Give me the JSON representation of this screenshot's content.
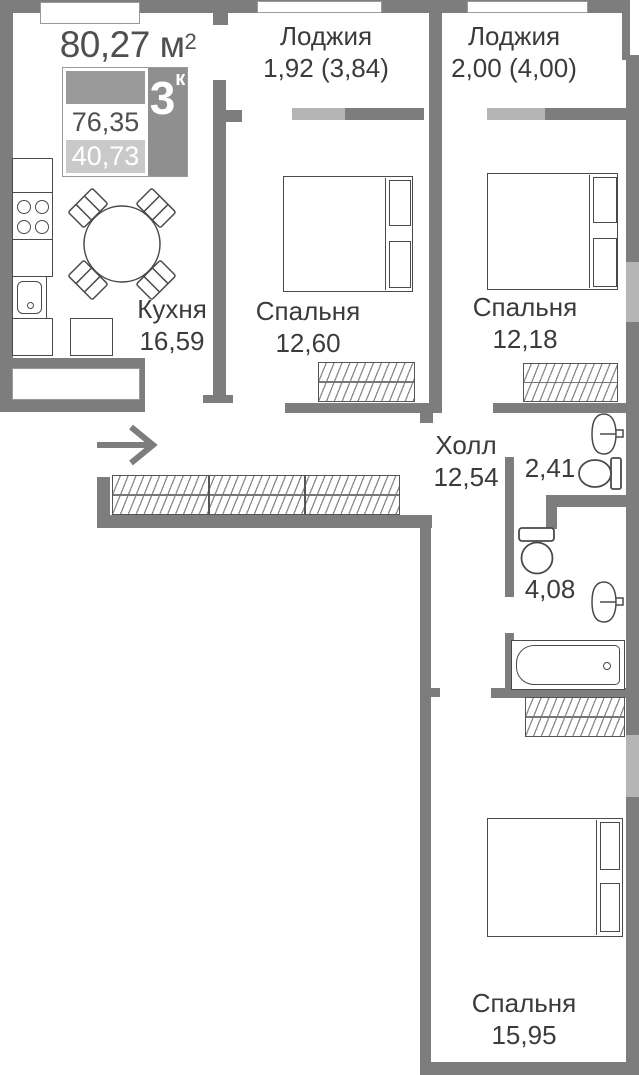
{
  "title": {
    "area_value": "80,27",
    "area_unit": "м",
    "area_sup": "2"
  },
  "legend": {
    "rooms_count": "3",
    "rooms_suffix": "к",
    "total_area": "76,35",
    "living_area": "40,73"
  },
  "rooms": {
    "kitchen": {
      "name": "Кухня",
      "area": "16,59"
    },
    "bedroom1": {
      "name": "Спальня",
      "area": "12,60"
    },
    "bedroom2": {
      "name": "Спальня",
      "area": "12,18"
    },
    "bedroom3": {
      "name": "Спальня",
      "area": "15,95"
    },
    "hall": {
      "name": "Холл",
      "area": "12,54"
    },
    "wc": {
      "area": "2,41"
    },
    "bathroom": {
      "area": "4,08"
    },
    "loggia1": {
      "name": "Лоджия",
      "area": "1,92 (3,84)"
    },
    "loggia2": {
      "name": "Лоджия",
      "area": "2,00 (4,00)"
    }
  },
  "icons": {
    "entry_arrow": "arrow-right"
  },
  "colors": {
    "wall": "#7d7d7d",
    "window": "#b5b5b5",
    "furniture_stroke": "#4a4a4a",
    "text": "#3b3b3b",
    "legend_dark": "#8f8f8f",
    "legend_light": "#c9c9c9"
  }
}
